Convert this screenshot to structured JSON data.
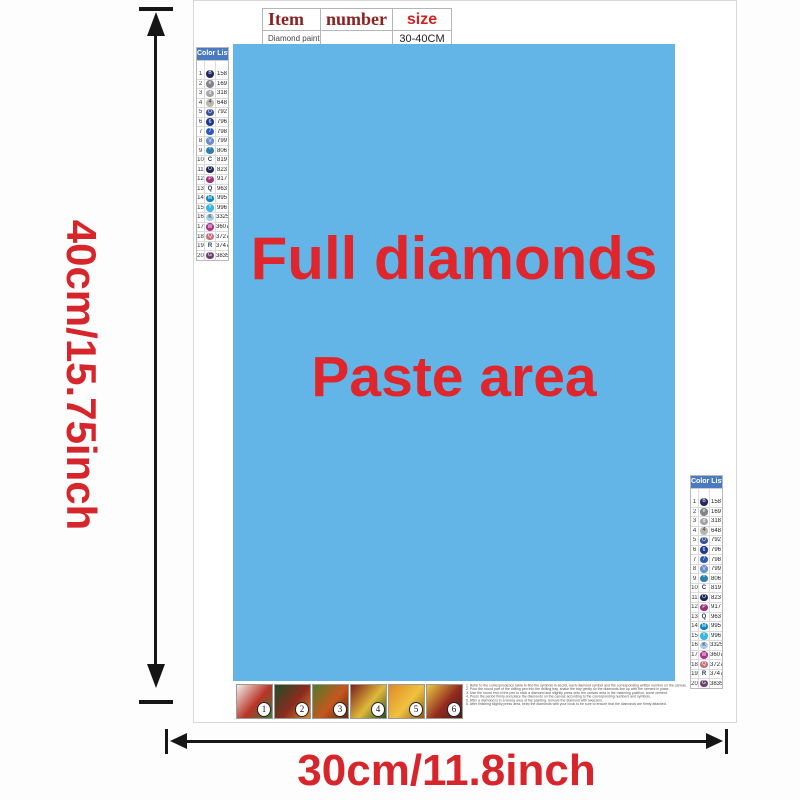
{
  "dimensions": {
    "height_label": "40cm/15.75inch",
    "width_label": "30cm/11.8inch"
  },
  "item_table": {
    "col_item": "Item",
    "col_number": "number",
    "col_size": "size",
    "row_item": "Diamond painting",
    "row_number": "",
    "row_size": "30-40CM"
  },
  "paste_area": {
    "line1": "Full diamonds",
    "line2": "Paste area",
    "bg_color": "#63b4e7",
    "text_color": "#df262c"
  },
  "color_list": {
    "title": "Color List",
    "columns": [
      "No.",
      "Diamond",
      "Color"
    ],
    "rows": [
      {
        "no": "1",
        "code": "158",
        "sym": "B",
        "circle": "#232a5c"
      },
      {
        "no": "2",
        "code": "169",
        "sym": "e",
        "circle": "#82838c"
      },
      {
        "no": "3",
        "code": "318",
        "sym": "d",
        "circle": "#a3a3aa"
      },
      {
        "no": "4",
        "code": "648",
        "sym": "4",
        "circle": "#b8b6ad",
        "dark_text": true
      },
      {
        "no": "5",
        "code": "792",
        "sym": "O",
        "circle": "#3d509a"
      },
      {
        "no": "6",
        "code": "796",
        "sym": "6",
        "circle": "#1f3a8c"
      },
      {
        "no": "7",
        "code": "798",
        "sym": "7",
        "circle": "#2c5cb0"
      },
      {
        "no": "8",
        "code": "799",
        "sym": "V",
        "circle": "#6b8cce"
      },
      {
        "no": "9",
        "code": "806",
        "sym": "*",
        "circle": "#2e7fae"
      },
      {
        "no": "10",
        "code": "819",
        "sym": "C",
        "circle": null
      },
      {
        "no": "11",
        "code": "823",
        "sym": "O",
        "circle": "#1c2956"
      },
      {
        "no": "12",
        "code": "917",
        "sym": "P",
        "circle": "#9c2f77"
      },
      {
        "no": "13",
        "code": "963",
        "sym": "Q",
        "circle": null
      },
      {
        "no": "14",
        "code": "995",
        "sym": "M",
        "circle": "#0e86c0"
      },
      {
        "no": "15",
        "code": "996",
        "sym": "Y",
        "circle": "#3cb4e5"
      },
      {
        "no": "16",
        "code": "3325",
        "sym": "K",
        "circle": "#a9cce9",
        "dark_text": true
      },
      {
        "no": "17",
        "code": "3607",
        "sym": "W",
        "circle": "#a93487"
      },
      {
        "no": "18",
        "code": "3727",
        "sym": "Q",
        "circle": "#c4717f"
      },
      {
        "no": "19",
        "code": "3747",
        "sym": "R",
        "circle": null
      },
      {
        "no": "20",
        "code": "3835",
        "sym": "G",
        "circle": "#6e4170"
      }
    ]
  },
  "bottom": {
    "thumbnails": [
      {
        "num": "1",
        "colors": [
          "#f3f0ea",
          "#b93327",
          "#3f7d3a"
        ]
      },
      {
        "num": "2",
        "colors": [
          "#1f4d27",
          "#8c2a1e",
          "#d98a2b"
        ]
      },
      {
        "num": "3",
        "colors": [
          "#4f7c2c",
          "#c6561f",
          "#5d2c12"
        ]
      },
      {
        "num": "4",
        "colors": [
          "#7c1f1a",
          "#e0b93a",
          "#27512b"
        ]
      },
      {
        "num": "5",
        "colors": [
          "#e08a27",
          "#f0c23f",
          "#8a5a16"
        ]
      },
      {
        "num": "6",
        "colors": [
          "#e8c93f",
          "#942a20",
          "#452018"
        ]
      }
    ],
    "instructions": [
      "1. Refer to the correspondence table to find the symbols in secret, each diamond symbol and the corresponding written number on the canvas.",
      "2. Pour the round part of the drilling pen into the drilling tray, shake the tray gently so the diamonds line up with the cement in place.",
      "3. Use the round end of the pen to stick a diamond and slightly press onto the canvas area in the matching position, some cement.",
      "4. Press the period firmly and place the diamonds on the canvas according to the corresponding numbers and symbols.",
      "5. After a diamond is in a wrong area of the painting, remove the diamond with tweezers.",
      "6. After finishing slightly press area, keep the diamonds with your book to be sure to ensure that the diamonds are firmly attached."
    ]
  }
}
